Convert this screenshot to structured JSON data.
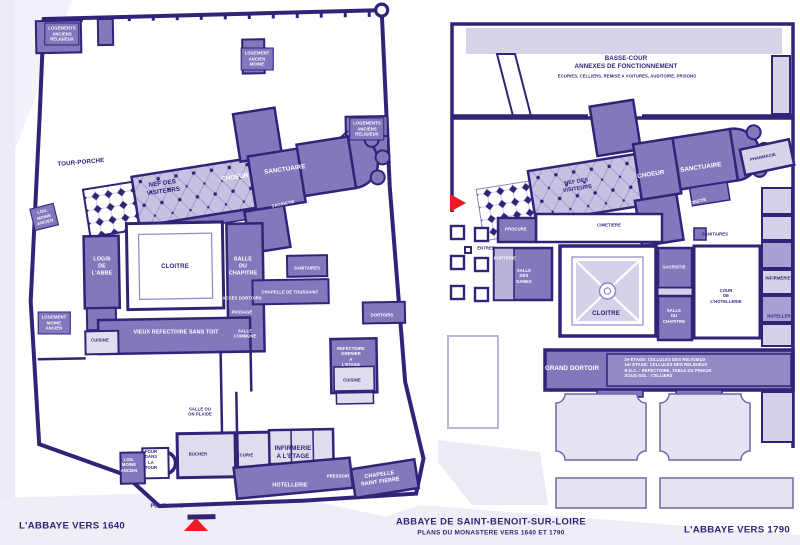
{
  "title": {
    "main": "ABBAYE DE SAINT-BENOIT-SUR-LOIRE",
    "subtitle": "PLANS DU MONASTERE VERS 1640 ET 1790"
  },
  "colors": {
    "ink": "#2f2478",
    "room_purple": "#8478bd",
    "light_lavender": "#c7c2e2",
    "pale_room": "#dfdcee",
    "entrance_marker_red": "#ed1c24"
  },
  "plan_1640": {
    "caption": "L'ABBAYE VERS 1640",
    "caption_x": 72,
    "caption_y": 526,
    "labels": [
      {
        "name": "label-logements-anciens-religieux-nw",
        "text": "LOGEMENTS\nANCIENS\nRELIGIEUX",
        "x": 62,
        "y": 34,
        "cls": "room f35"
      },
      {
        "name": "label-logement-ancien-moine",
        "text": "LOGEMENT\nANCIEN\nMOINE",
        "x": 257,
        "y": 59,
        "cls": "room f35"
      },
      {
        "name": "label-logements-anciens-religieux-ne",
        "text": "LOGEMENTS\nANCIENS\nRELIGIEUX",
        "x": 367,
        "y": 129,
        "cls": "room f35"
      },
      {
        "name": "label-tour-porche",
        "text": "TOUR-PORCHE",
        "x": 81,
        "y": 163,
        "cls": "dk f55",
        "rot": -5
      },
      {
        "name": "label-nef-des-visiteurs",
        "text": "NEF DES\nVISITEURS",
        "x": 163,
        "y": 188,
        "cls": "dk f55",
        "rot": -8
      },
      {
        "name": "label-choeur",
        "text": "CHOEUR",
        "x": 235,
        "y": 178,
        "cls": "wh f55",
        "rot": -8
      },
      {
        "name": "label-sanctuaire",
        "text": "SANCTUAIRE",
        "x": 285,
        "y": 170,
        "cls": "wh f55",
        "rot": -8
      },
      {
        "name": "label-sacristie",
        "text": "SACRISTIE",
        "x": 283,
        "y": 204,
        "cls": "wh f35",
        "rot": -12
      },
      {
        "name": "label-log-moine-ancien-ouest",
        "text": "LOG.\nMOINE\nANCIEN",
        "x": 44,
        "y": 217,
        "cls": "room f35",
        "rot": -14
      },
      {
        "name": "label-logis-de-l-abbe",
        "text": "LOGIS\nDE\nL'ABBE",
        "x": 102,
        "y": 267,
        "cls": "wh f5"
      },
      {
        "name": "label-cloitre",
        "text": "CLOITRE",
        "x": 175,
        "y": 267,
        "cls": "dk f55"
      },
      {
        "name": "label-salle-du-chapitre",
        "text": "SALLE\nDU\nCHAPITRE",
        "x": 243,
        "y": 267,
        "cls": "wh f5"
      },
      {
        "name": "label-sanitaires",
        "text": "SANITAIRES",
        "x": 307,
        "y": 268,
        "cls": "wh f35"
      },
      {
        "name": "label-chapelle-de-toussaint",
        "text": "CHAPELLE DE TOUSSAINT",
        "x": 290,
        "y": 292,
        "cls": "wh f35"
      },
      {
        "name": "label-acces-dortoirs",
        "text": "ACCES DORTOIRS",
        "x": 242,
        "y": 298,
        "cls": "wh f35"
      },
      {
        "name": "label-passage",
        "text": "PASSAGE",
        "x": 242,
        "y": 312,
        "cls": "wh f35"
      },
      {
        "name": "label-salle-commune",
        "text": "SALLE\nCOMMUNE",
        "x": 245,
        "y": 334,
        "cls": "wh f35"
      },
      {
        "name": "label-logement-moine-ancien",
        "text": "LOGEMENT\nMOINE\nANCIEN",
        "x": 54,
        "y": 323,
        "cls": "room f35"
      },
      {
        "name": "label-vieux-refectoire",
        "text": "VIEUX REFECTOIRE SANS TOIT",
        "x": 176,
        "y": 333,
        "cls": "wh f5"
      },
      {
        "name": "label-cuisine-ouest",
        "text": "CUISINE",
        "x": 100,
        "y": 340,
        "cls": "dk f35"
      },
      {
        "name": "label-dortoirs",
        "text": "DORTOIRS",
        "x": 382,
        "y": 315,
        "cls": "wh f35"
      },
      {
        "name": "label-refectoire-grenier",
        "text": "REFECTOIRE\nGRENIER\nA\nL'ETAGE",
        "x": 351,
        "y": 357,
        "cls": "wh f35"
      },
      {
        "name": "label-cuisine-est",
        "text": "CUISINE",
        "x": 352,
        "y": 380,
        "cls": "dk f35"
      },
      {
        "name": "label-salle-ou-on-plaide",
        "text": "SALLE OU\nON PLAIDE",
        "x": 200,
        "y": 412,
        "cls": "dk f35"
      },
      {
        "name": "label-four-dans-la-tour",
        "text": "FOUR\nDANS\nLA\nTOUR",
        "x": 151,
        "y": 460,
        "cls": "dk f35"
      },
      {
        "name": "label-log-moine-ancien-sud",
        "text": "LOG.\nMOINE\nANCIEN",
        "x": 129,
        "y": 465,
        "cls": "wh f35"
      },
      {
        "name": "label-bucher",
        "text": "BUCHER",
        "x": 198,
        "y": 454,
        "cls": "dk f35"
      },
      {
        "name": "label-ecurie",
        "text": "ECURIE",
        "x": 245,
        "y": 455,
        "cls": "dk f35"
      },
      {
        "name": "label-infirmerie-a-l-etage",
        "text": "INFIRMERIE\nA L'ETAGE",
        "x": 293,
        "y": 453,
        "cls": "dk f55"
      },
      {
        "name": "label-hotellerie",
        "text": "HOTELLERIE",
        "x": 290,
        "y": 486,
        "cls": "wh f5"
      },
      {
        "name": "label-pressoir",
        "text": "PRESSOIR",
        "x": 338,
        "y": 476,
        "cls": "wh f35"
      },
      {
        "name": "label-chapelle-saint-pierre",
        "text": "CHAPELLE\nSAINT PIERRE",
        "x": 380,
        "y": 479,
        "cls": "wh f5",
        "rot": -8
      },
      {
        "name": "label-pont-levis",
        "text": "PONT-LEVIS",
        "x": 167,
        "y": 507,
        "cls": "dk f5"
      }
    ]
  },
  "plan_1790": {
    "caption": "L'ABBAYE VERS 1790",
    "caption_x": 737,
    "caption_y": 530,
    "labels": [
      {
        "name": "label-basse-cour",
        "text": "BASSE-COUR\nANNEXES DE FONCTIONNEMENT",
        "x": 626,
        "y": 63,
        "cls": "dk f55"
      },
      {
        "name": "label-basse-cour-detail",
        "text": "ECURIES, CELLIERS, REMISE A VOITURES, AUDITOIRE, PRISONS",
        "x": 627,
        "y": 76,
        "cls": "dk f35"
      },
      {
        "name": "label-nef-des-visiteurs",
        "text": "NEF DES\nVISITEURS",
        "x": 577,
        "y": 186,
        "cls": "dk f5",
        "rot": -9
      },
      {
        "name": "label-choeur",
        "text": "CHOEUR",
        "x": 651,
        "y": 175,
        "cls": "wh f55",
        "rot": -9
      },
      {
        "name": "label-sanctuaire",
        "text": "SANCTUAIRE",
        "x": 701,
        "y": 168,
        "cls": "wh f55",
        "rot": -8
      },
      {
        "name": "label-pharmacie",
        "text": "PHARMACIE",
        "x": 763,
        "y": 157,
        "cls": "dk f35",
        "rot": -12
      },
      {
        "name": "label-sacristie-abside",
        "text": "SACRISTIE",
        "x": 695,
        "y": 202,
        "cls": "wh f35",
        "rot": -14
      },
      {
        "name": "label-cimetiere",
        "text": "CIMETIERE",
        "x": 609,
        "y": 225,
        "cls": "dk f35"
      },
      {
        "name": "label-procure",
        "text": "PROCURE",
        "x": 516,
        "y": 229,
        "cls": "wh f35"
      },
      {
        "name": "label-entree",
        "text": "ENTREE",
        "x": 486,
        "y": 248,
        "cls": "dk f35"
      },
      {
        "name": "label-porterie",
        "text": "PORTERIE",
        "x": 505,
        "y": 258,
        "cls": "wh f35"
      },
      {
        "name": "label-salle-des-dames",
        "text": "SALLE\nDES\nDAMES",
        "x": 524,
        "y": 276,
        "cls": "wh f35"
      },
      {
        "name": "label-sanitaires",
        "text": "SANITAIRES",
        "x": 715,
        "y": 234,
        "cls": "dk f35"
      },
      {
        "name": "label-sacristie-cloitre",
        "text": "SACRISTIE",
        "x": 674,
        "y": 267,
        "cls": "wh f35"
      },
      {
        "name": "label-salle-du-chapitre",
        "text": "SALLE\nDU\nCHAPITRE",
        "x": 674,
        "y": 316,
        "cls": "wh f35"
      },
      {
        "name": "label-cloitre",
        "text": "CLOITRE",
        "x": 606,
        "y": 314,
        "cls": "dk f55"
      },
      {
        "name": "label-cour-de-l-hotellerie",
        "text": "COUR\nDE\nL'HOTELLERIE",
        "x": 726,
        "y": 296,
        "cls": "dk f35"
      },
      {
        "name": "label-infirmerie",
        "text": "INFIRMERIE",
        "x": 778,
        "y": 278,
        "cls": "dk f35"
      },
      {
        "name": "label-hotellerie",
        "text": "HOTELLERIE",
        "x": 781,
        "y": 316,
        "cls": "dk f35"
      },
      {
        "name": "label-grand-dortoir",
        "text": "GRAND DORTOIR",
        "x": 572,
        "y": 369,
        "cls": "wh f55"
      },
      {
        "name": "label-dortoir-etages",
        "text": "2e ETAGE: CELLULES DES RELIGIEUX\n1er ETAGE: CELLULES DES RELIGIEUX\nR.D.C. : REFECTOIRE, TABLE DU PRIEUR\nSOUS-SOL : CELLIERS",
        "x": 668,
        "y": 368,
        "cls": "wh f35 left"
      }
    ]
  }
}
